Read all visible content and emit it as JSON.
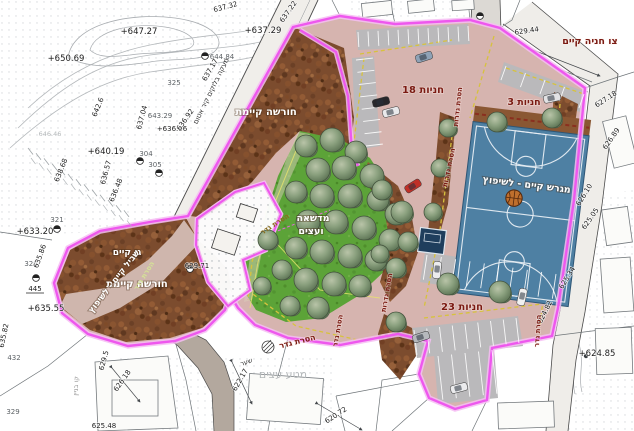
{
  "plan": {
    "colors": {
      "boundary_magenta": "#ee57ee",
      "pavement_pink": "#d6b4af",
      "path_pink": "#cfb6ad",
      "lawn_green": "#5ca338",
      "grove_brown": "#7c4c2e",
      "court_blue": "#4e80a3",
      "stall_gray": "#bab9bb",
      "label_red": "#7a1a12"
    },
    "area_labels": {
      "grove_upper": "חורשה קיימת",
      "grove_lower": "חורשה קיימת",
      "garden": "גן קיים",
      "path_renovate": "שביל קיים - לשיפוץ",
      "lawn_line1": "מדשאה",
      "lawn_line2": "ועצים",
      "court": "מגרש קיים - לשיפוץ",
      "wall_note": "מעקה בלוקים קיר אטום",
      "parking_existing": "צו חניה קיים",
      "orchard_bg": "מטע עצים",
      "gate": "שער",
      "building_line": "קו בניין"
    },
    "parking_labels": {
      "p18": "18 חניות",
      "p3": "3 חניות",
      "p23": "23 חניות"
    },
    "fence_notes": {
      "remove_fence": "הסרת גדר",
      "remove_fences": "הסרת גדרות"
    },
    "spot_elevations": [
      "+647.27",
      "+650.69",
      "+637.29",
      "637.22",
      "637.32",
      "644.84",
      "637.17",
      "642.6",
      "637.04",
      "643.29",
      "+636.96",
      "636.92",
      "+640.19",
      "304",
      "305",
      "636.57",
      "636.48",
      "638.68",
      "646.46",
      "+633.20",
      "321",
      "326",
      "635.86",
      "445",
      "+635.55",
      "635.82",
      "432",
      "329",
      "629.5",
      "626.18",
      "625.48",
      "629.71",
      "622.17",
      "620.72",
      "629.44",
      "627.18",
      "626.89",
      "626.10",
      "625.05",
      "625.34",
      "624.82",
      "+624.85",
      "325"
    ]
  }
}
